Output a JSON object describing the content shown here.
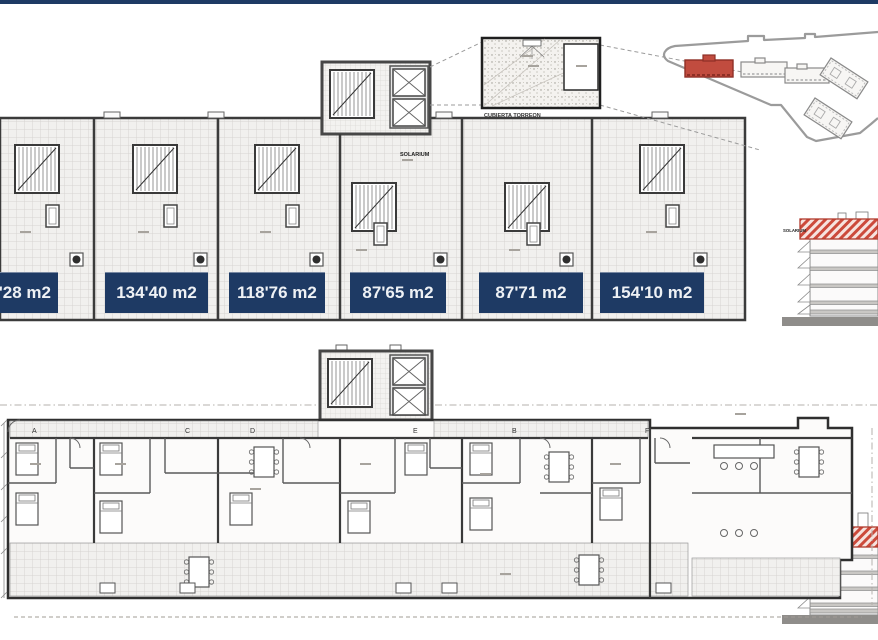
{
  "page": {
    "top_bar_color": "#1e3a64",
    "background": "#ffffff"
  },
  "roof_plan": {
    "area_labels": [
      "4'28 m2",
      "134'40 m2",
      "118'76 m2",
      "87'65 m2",
      "87'71 m2",
      "154'10 m2"
    ],
    "center_label": "SOLARIUM",
    "inset_caption": "CUBIERTA TORREON"
  },
  "floor_plan": {
    "grid_letters": [
      "A",
      "C",
      "D",
      "E",
      "B",
      "F"
    ]
  },
  "sections": {
    "top_label": "SOLARIUM",
    "bottom_label": "PLANTA 6"
  },
  "colors": {
    "navy": "#1e3a64",
    "highlight_red": "#c14c3f",
    "section_red": "#cc4a3b"
  }
}
